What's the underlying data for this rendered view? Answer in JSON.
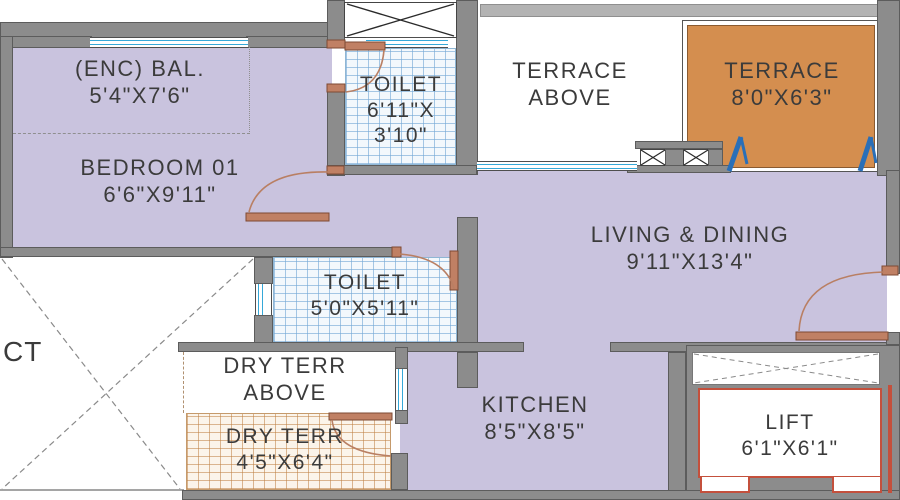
{
  "plan": {
    "rooms": {
      "enc_bal": {
        "name": "(ENC) BAL.",
        "dims": "5'4\"X7'6\""
      },
      "bedroom01": {
        "name": "BEDROOM 01",
        "dims": "6'6\"X9'11\""
      },
      "toilet1": {
        "name": "TOILET",
        "dims_line1": "6'11\"X",
        "dims_line2": "3'10\""
      },
      "terrace_above": {
        "name_line1": "TERRACE",
        "name_line2": "ABOVE"
      },
      "terrace": {
        "name": "TERRACE",
        "dims": "8'0\"X6'3\""
      },
      "living_dining": {
        "name": "LIVING & DINING",
        "dims": "9'11\"X13'4\""
      },
      "toilet2": {
        "name": "TOILET",
        "dims": "5'0\"X5'11\""
      },
      "duct": {
        "name": "CT"
      },
      "dry_terr_above": {
        "name_line1": "DRY TERR",
        "name_line2": "ABOVE"
      },
      "dry_terr": {
        "name": "DRY TERR",
        "dims": "4'5\"X6'4\""
      },
      "kitchen": {
        "name": "KITCHEN",
        "dims": "8'5\"X8'5\""
      },
      "lift": {
        "name": "LIFT",
        "dims": "6'1\"X6'1\""
      }
    },
    "colors": {
      "room_fill": "#c9c3de",
      "terrace_fill": "#d48e4f",
      "wall": "#8c8c8c",
      "door": "#b97f63",
      "window": "#35a8d8",
      "door_swing_blue": "#2a6fb8",
      "lift_border": "#c4503c",
      "text": "#3b3b3b"
    }
  }
}
